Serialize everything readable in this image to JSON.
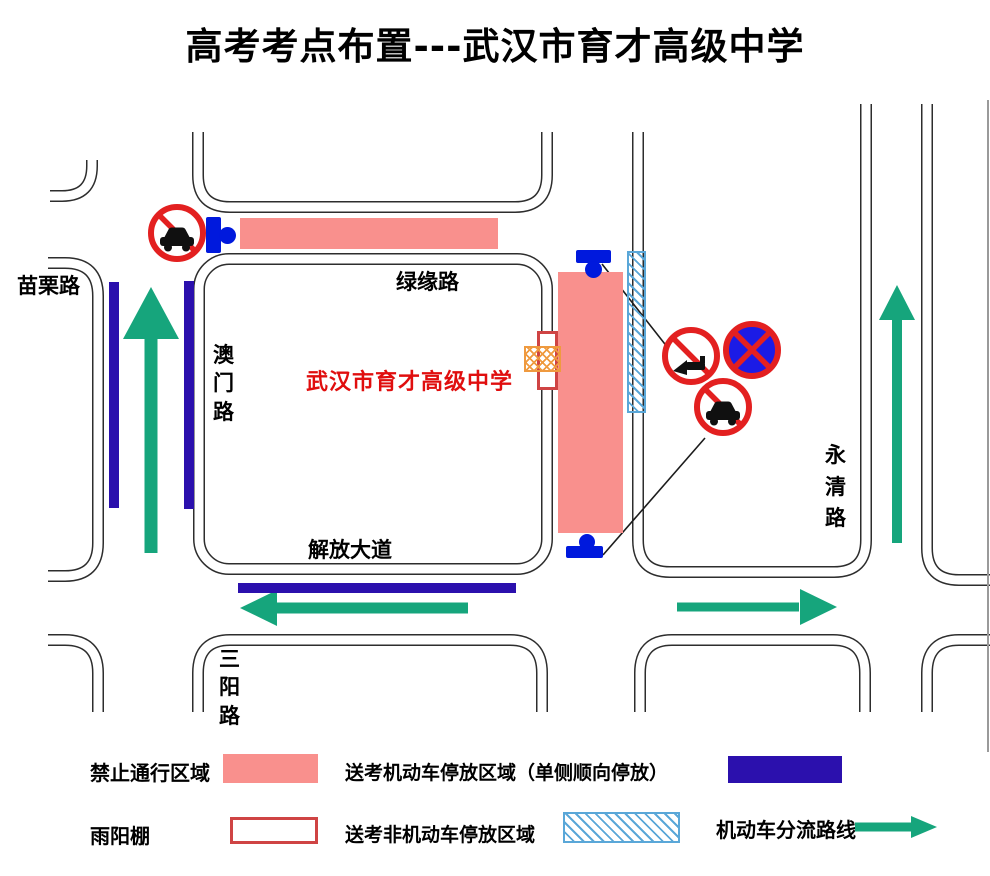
{
  "title": "高考考点布置---武汉市育才高级中学",
  "map": {
    "school_name": "武汉市育才高级中学",
    "roads": {
      "miaoli": "苗栗路",
      "lvyuan": "绿缘路",
      "aomen": "澳门路",
      "jiefang": "解放大道",
      "sanyang": "三阳路",
      "yongqing": "永清路"
    },
    "icons": {
      "no-motor-vehicles-sign": "red ring circle with black car and red diagonal",
      "no-honking-sign": "red ring circle with black horn and red diagonal",
      "no-stopping-sign": "red ring circle with blue fill and red X",
      "road-closure-barrier": "blue bar with blue dot"
    }
  },
  "legend": {
    "items": [
      {
        "label": "禁止通行区域",
        "swatch": "pink-fill"
      },
      {
        "label": "送考机动车停放区域（单侧顺向停放）",
        "swatch": "darkblue-fill"
      },
      {
        "label": "雨阳棚",
        "swatch": "red-outline"
      },
      {
        "label": "送考非机动车停放区域",
        "swatch": "blue-hatched"
      },
      {
        "label": "机动车分流路线",
        "swatch": "green-arrow"
      }
    ]
  },
  "colors": {
    "pink": "#f9908d",
    "darkblue": "#2b10ad",
    "barrier-blue": "#0019dd",
    "green": "#16a57c",
    "sign-red": "#e32020",
    "stop-blue": "#1b1be6",
    "hatch-blue": "#5aa7d8",
    "orange": "#ef9a3f",
    "shelter-red": "#cf4444",
    "red-text": "#e00e0e"
  }
}
